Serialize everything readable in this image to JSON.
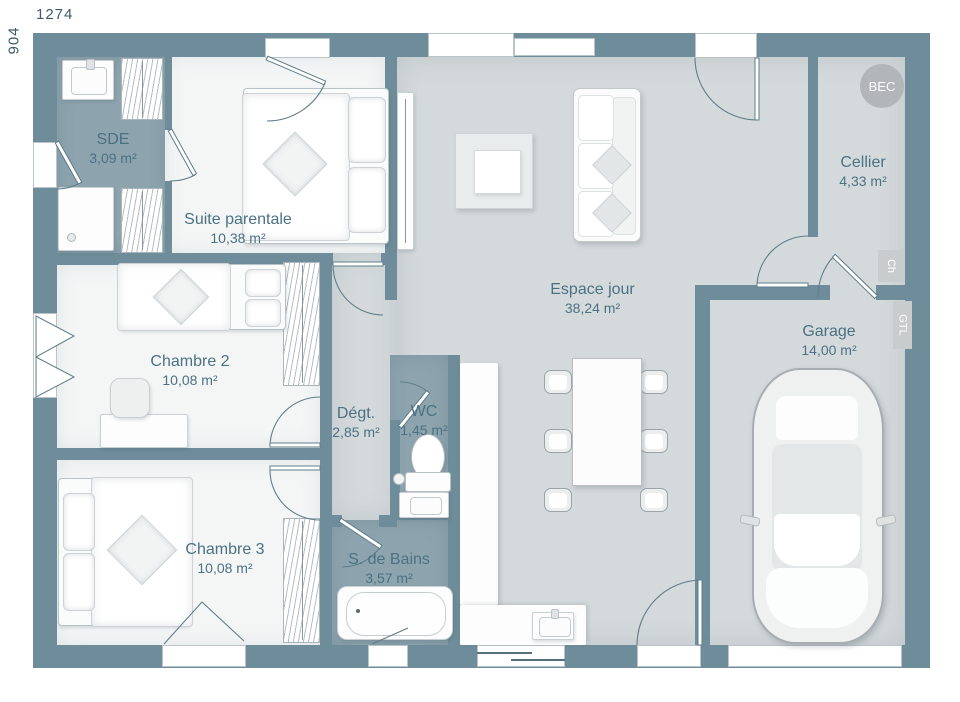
{
  "dimensions": {
    "width_label": "1274",
    "height_label": "904"
  },
  "rooms": {
    "sde": {
      "name": "SDE",
      "area": "3,09 m²"
    },
    "suite": {
      "name": "Suite parentale",
      "area": "10,38 m²"
    },
    "chambre2": {
      "name": "Chambre 2",
      "area": "10,08 m²"
    },
    "chambre3": {
      "name": "Chambre 3",
      "area": "10,08 m²"
    },
    "degt": {
      "name": "Dégt.",
      "area": "2,85 m²"
    },
    "wc": {
      "name": "WC",
      "area": "1,45 m²"
    },
    "sdb": {
      "name": "S. de Bains",
      "area": "3,57 m²"
    },
    "espace": {
      "name": "Espace jour",
      "area": "38,24 m²"
    },
    "cellier": {
      "name": "Cellier",
      "area": "4,33 m²"
    },
    "garage": {
      "name": "Garage",
      "area": "14,00 m²"
    }
  },
  "tags": {
    "bec": "BEC",
    "ch": "Ch",
    "gtl": "GTL"
  },
  "colors": {
    "wall": "#6e8c99",
    "wet_floor": "#8da4ae",
    "main_floor": "#d4d9db",
    "bedroom_floor": "#f4f6f6",
    "label_text": "#4b7183"
  }
}
